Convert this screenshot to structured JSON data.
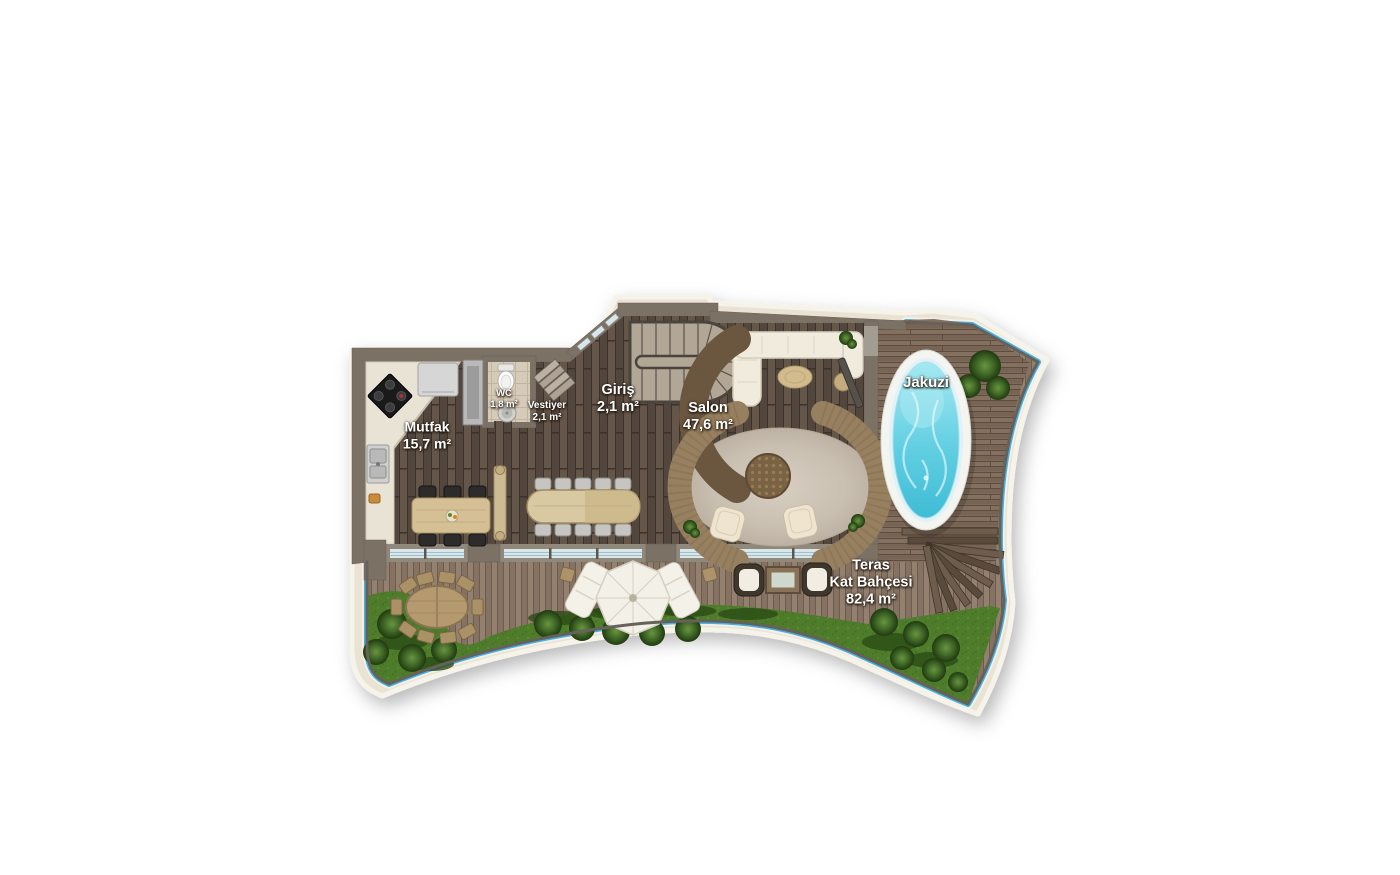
{
  "page": {
    "background": "#ffffff",
    "type": "residential-floor-plan"
  },
  "floorplan": {
    "labels": {
      "mutfak": {
        "name": "Mutfak",
        "area": "15,7 m²"
      },
      "wc": {
        "name": "WC",
        "area": "1,8 m²"
      },
      "vestiyer": {
        "name": "Vestiyer",
        "area": "2,1 m²"
      },
      "giris": {
        "name": "Giriş",
        "area": "2,1 m²"
      },
      "salon": {
        "name": "Salon",
        "area": "47,6 m²"
      },
      "jakuzi": {
        "name": "Jakuzi"
      },
      "teras": {
        "line1": "Teras",
        "line2": "Kat Bahçesi",
        "area": "82,4 m²"
      }
    },
    "colors": {
      "wall": "#7b7165",
      "interior_wood": "#5a4d44",
      "terrace_deck": "#8d7a6b",
      "jacuzzi_deck": "#7d6a5a",
      "walkway": "#eae3d4",
      "pool_edge_blue": "#45b1e2",
      "grass": "#4e7c2b",
      "jacuzzi_water": "#5fd0e2",
      "counter": "#e9e3d6",
      "label_text": "#ffffff"
    }
  }
}
